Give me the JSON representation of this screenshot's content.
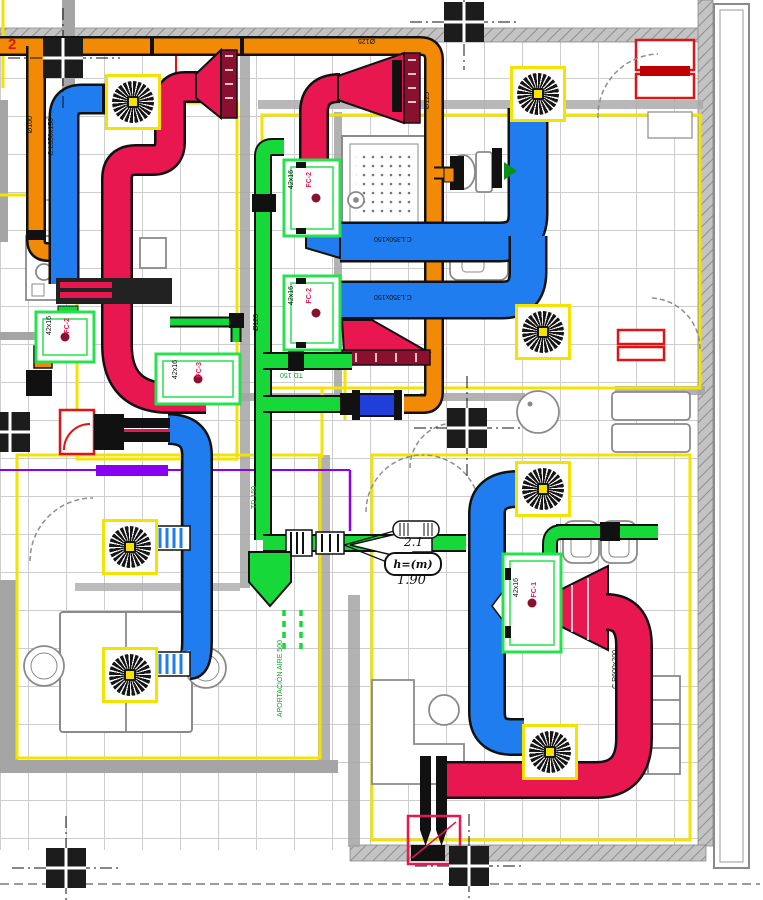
{
  "colors": {
    "supply_duct_blue": "#1f7df0",
    "return_duct_red": "#e8174f",
    "exhaust_duct_orange": "#f28a05",
    "fresh_air_duct_green": "#17d839",
    "room_boundary_yellow": "#f2e300",
    "alt_system_purple": "#8a00f0",
    "grille_dark_red": "#8a1030"
  },
  "duct_labels": {
    "orange_top": "Ø125",
    "orange_left": "Ø100",
    "orange_riser": "Ø125",
    "blue_topleft": "C.L350x150",
    "blue_run_upper": "C.L350x150",
    "blue_run_lower": "C.L350x150",
    "green_riser": "Ø125",
    "green_branch": "TD 150",
    "green_lower": "TD 150",
    "red_main": "C.R600x200"
  },
  "units": [
    {
      "size": "42x16",
      "tag": "FC-2"
    },
    {
      "size": "42x16",
      "tag": "FC-2"
    },
    {
      "size": "42x16",
      "tag": "FC-2"
    },
    {
      "size": "42x16",
      "tag": "FC-3"
    },
    {
      "size": "42x16",
      "tag": "FC-1"
    }
  ],
  "annotations": {
    "supply_air_note": "APORTACIÓN AIRE 500",
    "height_key": "h=(m)",
    "height_value": "1.90",
    "drop_value": "2.1",
    "section_mark": "2"
  }
}
